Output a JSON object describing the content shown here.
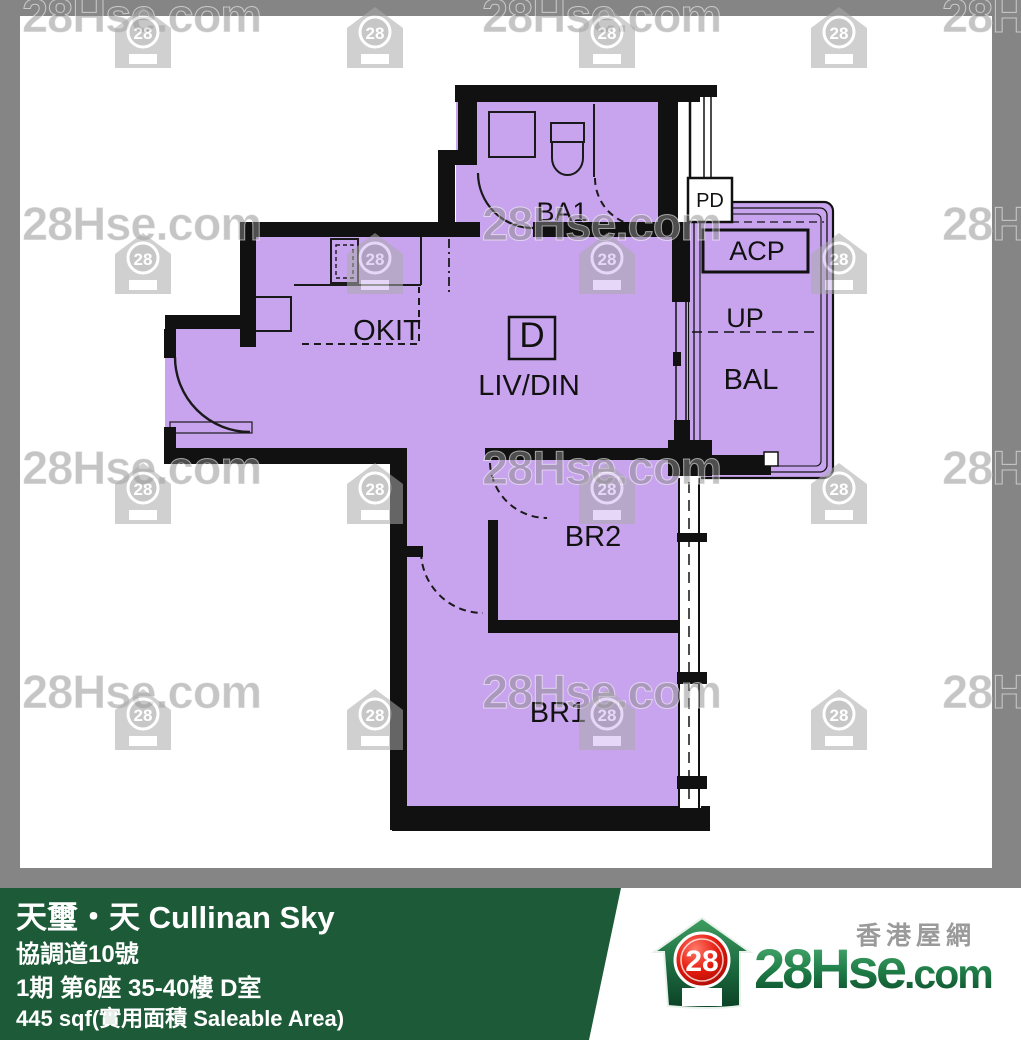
{
  "watermark": {
    "text": "28Hse.com",
    "badge": "28"
  },
  "plan": {
    "fill_color": "#c9a4ee",
    "wall_color": "#111111",
    "rooms": {
      "ba1": "BA1",
      "pd": "PD",
      "acp": "ACP",
      "up": "UP",
      "bal": "BAL",
      "okit": "OKIT",
      "unit": "D",
      "livdin": "LIV/DIN",
      "br2": "BR2",
      "br1": "BR1"
    }
  },
  "banner": {
    "bg_color": "#1d5a38",
    "title": "天璽・天 Cullinan Sky",
    "address": "協調道10號",
    "unit_info": "1期 第6座 35-40樓 D室",
    "area": "445 sqf(實用面積 Saleable Area)"
  },
  "logo": {
    "tagline": "香港屋網",
    "brand": "28Hse",
    "suffix": ".com",
    "badge": "28"
  }
}
